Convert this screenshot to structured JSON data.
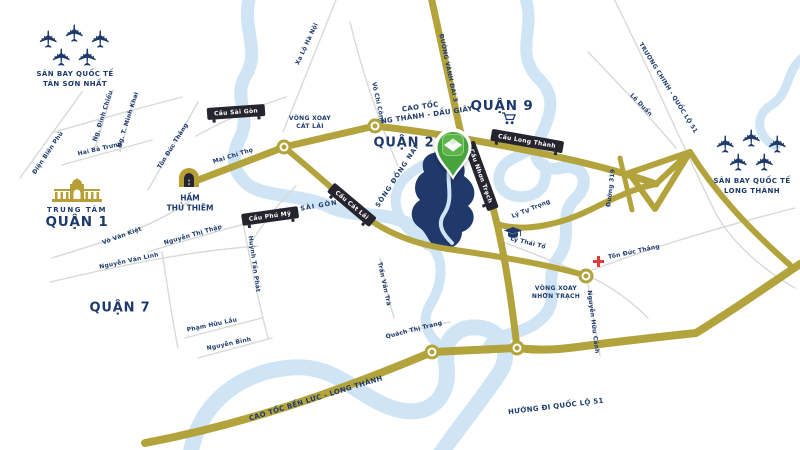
{
  "map": {
    "colors": {
      "road_gold": "#b3a33d",
      "river_blue": "#cfe5f6",
      "navy": "#1e3a6b",
      "badge_dark": "#26242e",
      "pin_green": "#47a33e",
      "pin_green_light": "#5cb44a",
      "hospital_red": "#e23b3b",
      "land_plot_navy": "#20396b",
      "minor_road_gray": "#d9d9d9"
    },
    "districts": [
      {
        "label": "QUẬN 9",
        "x": 502,
        "y": 106,
        "size": 13.5
      },
      {
        "label": "QUẬN 2",
        "x": 404,
        "y": 143,
        "size": 13
      },
      {
        "label": "QUẬN 7",
        "x": 120,
        "y": 308,
        "size": 13
      }
    ],
    "quan1": {
      "subtitle": "TRUNG TÂM",
      "title": "QUẬN 1"
    },
    "ham": {
      "line1": "HẦM",
      "line2": "THỦ THIÊM"
    },
    "airports": [
      {
        "name": "tan-son-nhat",
        "x": 75,
        "y": 46,
        "label_y": 79,
        "lines": [
          "SÂN BAY QUỐC TẾ",
          "TÂN SƠN NHẤT"
        ]
      },
      {
        "name": "long-thanh",
        "x": 752,
        "y": 151,
        "label_y": 186,
        "lines": [
          "SÂN BAY QUỐC TẾ",
          "LONG THÀNH"
        ]
      }
    ],
    "highway_labels": [
      {
        "lines": [
          "CAO TỐC",
          "LONG THÀNH - DẦU GIÂY"
        ],
        "x": 421,
        "y": 112,
        "rot": -8
      },
      {
        "lines": [
          "CAO TỐC BẾN LỨC - LONG THÀNH"
        ],
        "x": 316,
        "y": 399,
        "rot": -17
      },
      {
        "lines": [
          "HƯỚNG ĐI QUỐC LỘ 51"
        ],
        "x": 556,
        "y": 407,
        "rot": -7
      }
    ],
    "roundabout_labels": [
      {
        "lines": [
          "VÒNG XOAY",
          "CÁT LÁI"
        ],
        "x": 310,
        "y": 123
      },
      {
        "lines": [
          "VÒNG XOAY",
          "NHƠN TRẠCH"
        ],
        "x": 556,
        "y": 293
      }
    ],
    "bridges": [
      {
        "text": "Cầu Sài Gòn",
        "x": 236,
        "y": 112,
        "rot": -4
      },
      {
        "text": "Cầu Phú Mỹ",
        "x": 270,
        "y": 216,
        "rot": -8
      },
      {
        "text": "Cầu Cát Lái",
        "x": 352,
        "y": 205,
        "rot": 40
      },
      {
        "text": "Cầu Long Thành",
        "x": 527,
        "y": 141,
        "rot": 10
      },
      {
        "text": "Cầu Nhơn Trạch",
        "x": 481,
        "y": 176,
        "rot": 70
      }
    ],
    "street_labels": [
      {
        "text": "Ng. Đình Chiểu",
        "x": 103,
        "y": 116,
        "rot": -72
      },
      {
        "text": "Ng. T. Minh Khai",
        "x": 128,
        "y": 120,
        "rot": -72
      },
      {
        "text": "Hai Bà Trưng",
        "x": 100,
        "y": 149,
        "rot": -13
      },
      {
        "text": "Điện Biên Phủ",
        "x": 48,
        "y": 153,
        "rot": -56
      },
      {
        "text": "Tôn Đức Thắng",
        "x": 173,
        "y": 146,
        "rot": -58
      },
      {
        "text": "Mai Chí Thọ",
        "x": 233,
        "y": 156,
        "rot": -17
      },
      {
        "text": "Xa Lộ Hà Nội",
        "x": 307,
        "y": 44,
        "rot": -65
      },
      {
        "text": "Võ Chí Công",
        "x": 378,
        "y": 103,
        "rot": 78
      },
      {
        "text": "ĐƯỜNG VÀNH ĐAI 3",
        "x": 448,
        "y": 68,
        "rot": 78
      },
      {
        "text": "Võ Văn Kiệt",
        "x": 122,
        "y": 236,
        "rot": -20
      },
      {
        "text": "Nguyễn Thị Thập",
        "x": 193,
        "y": 235,
        "rot": -16
      },
      {
        "text": "Nguyễn Văn Linh",
        "x": 129,
        "y": 261,
        "rot": -12
      },
      {
        "text": "Huỳnh Tấn Phát",
        "x": 254,
        "y": 264,
        "rot": 82
      },
      {
        "text": "Phạm Hữu Lầu",
        "x": 212,
        "y": 325,
        "rot": -12
      },
      {
        "text": "Nguyễn Bình",
        "x": 229,
        "y": 344,
        "rot": -12
      },
      {
        "text": "Trần Văn Trà",
        "x": 384,
        "y": 284,
        "rot": 78
      },
      {
        "text": "Quách Thị Trang",
        "x": 414,
        "y": 330,
        "rot": -14
      },
      {
        "text": "Lý Tự Trọng",
        "x": 531,
        "y": 209,
        "rot": -22
      },
      {
        "text": "Lý Thái Tổ",
        "x": 528,
        "y": 243,
        "rot": 14
      },
      {
        "text": "Tôn Đức Thắng",
        "x": 634,
        "y": 252,
        "rot": -12
      },
      {
        "text": "Nguyễn Hữu Cảnh",
        "x": 593,
        "y": 322,
        "rot": 83
      },
      {
        "text": "Đường 319",
        "x": 611,
        "y": 188,
        "rot": -83
      },
      {
        "text": "Lê Duẩn",
        "x": 641,
        "y": 105,
        "rot": 46
      },
      {
        "text": "TRƯỜNG CHINH - QUỐC LỘ 51",
        "x": 668,
        "y": 88,
        "rot": 58
      }
    ],
    "river_labels": [
      {
        "text": "SÔNG SÀI GÒN",
        "x": 305,
        "y": 208,
        "rot": -10
      },
      {
        "text": "SÔNG ĐỒNG NAI",
        "x": 397,
        "y": 176,
        "rot": -57
      }
    ],
    "roundabouts": [
      {
        "x": 284,
        "y": 147
      },
      {
        "x": 375,
        "y": 126
      },
      {
        "x": 432,
        "y": 352
      },
      {
        "x": 517,
        "y": 348
      },
      {
        "x": 586,
        "y": 276
      }
    ],
    "plane_offsets": [
      [
        -26,
        -7
      ],
      [
        0,
        -13
      ],
      [
        26,
        -7
      ],
      [
        -13,
        11
      ],
      [
        13,
        11
      ]
    ],
    "plane_glyph": "✈",
    "icons": {
      "pin": "location-pin",
      "market": "ben-thanh-market-icon",
      "tunnel": "tunnel-icon",
      "school": "graduation-cap-icon",
      "cart": "shopping-cart-icon",
      "hospital": "hospital-cross-icon",
      "plane": "airplane-icon"
    }
  }
}
